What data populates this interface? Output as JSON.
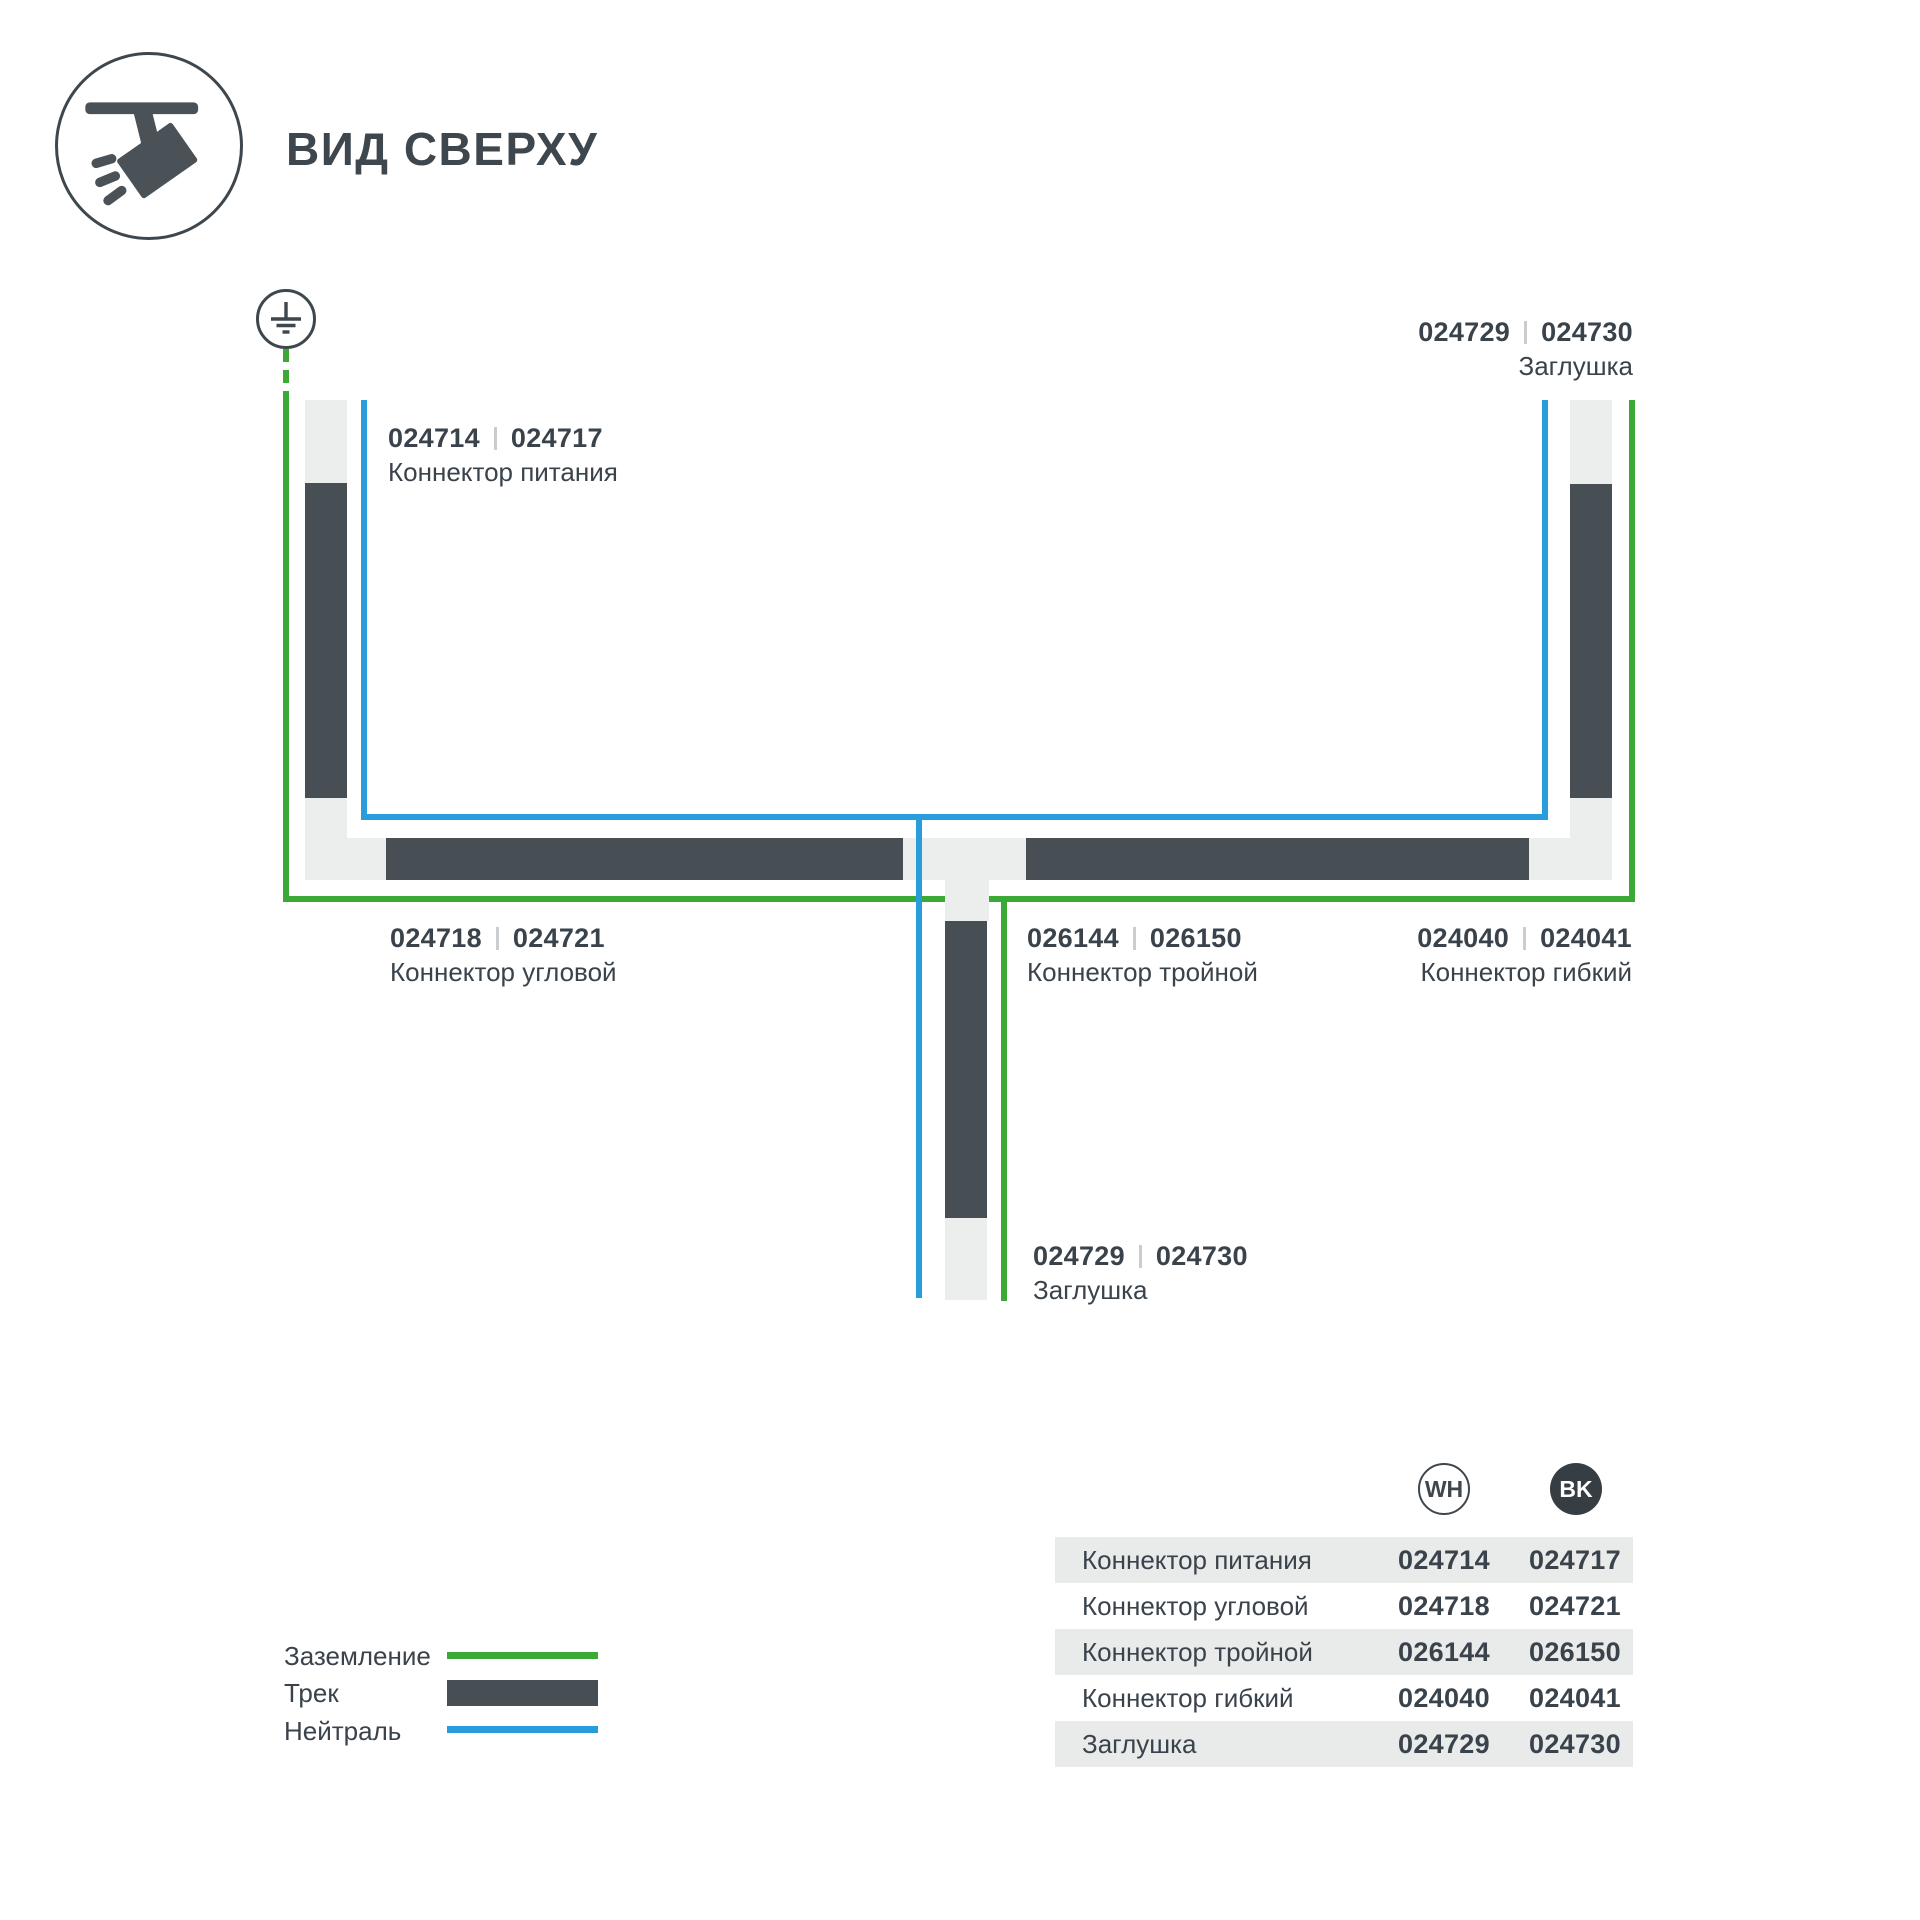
{
  "header": {
    "title": "ВИД СВЕРХУ",
    "icon": "track-spotlight-icon"
  },
  "diagram": {
    "ground_icon": "earth-ground-icon",
    "labels": {
      "power": {
        "wh": "024714",
        "bk": "024717",
        "name": "Коннектор питания"
      },
      "endcap_top": {
        "wh": "024729",
        "bk": "024730",
        "name": "Заглушка"
      },
      "corner": {
        "wh": "024718",
        "bk": "024721",
        "name": "Коннектор угловой"
      },
      "triple": {
        "wh": "026144",
        "bk": "026150",
        "name": "Коннектор тройной"
      },
      "flexible": {
        "wh": "024040",
        "bk": "024041",
        "name": "Коннектор гибкий"
      },
      "endcap_bottom": {
        "wh": "024729",
        "bk": "024730",
        "name": "Заглушка"
      }
    }
  },
  "legend": {
    "ground": "Заземление",
    "track": "Трек",
    "neutral": "Нейтраль"
  },
  "table": {
    "columns": {
      "wh": "WH",
      "bk": "BK"
    },
    "rows": [
      {
        "name": "Коннектор питания",
        "wh": "024714",
        "bk": "024717"
      },
      {
        "name": "Коннектор угловой",
        "wh": "024718",
        "bk": "024721"
      },
      {
        "name": "Коннектор тройной",
        "wh": "026144",
        "bk": "026150"
      },
      {
        "name": "Коннектор гибкий",
        "wh": "024040",
        "bk": "024041"
      },
      {
        "name": "Заглушка",
        "wh": "024729",
        "bk": "024730"
      }
    ]
  },
  "colors": {
    "ground_green": "#3BA935",
    "neutral_blue": "#299CDB",
    "track_dark": "#474F54",
    "connector_light": "#ECEDED",
    "text_dark": "#3A434B",
    "row_gray": "#E9EAEA"
  }
}
